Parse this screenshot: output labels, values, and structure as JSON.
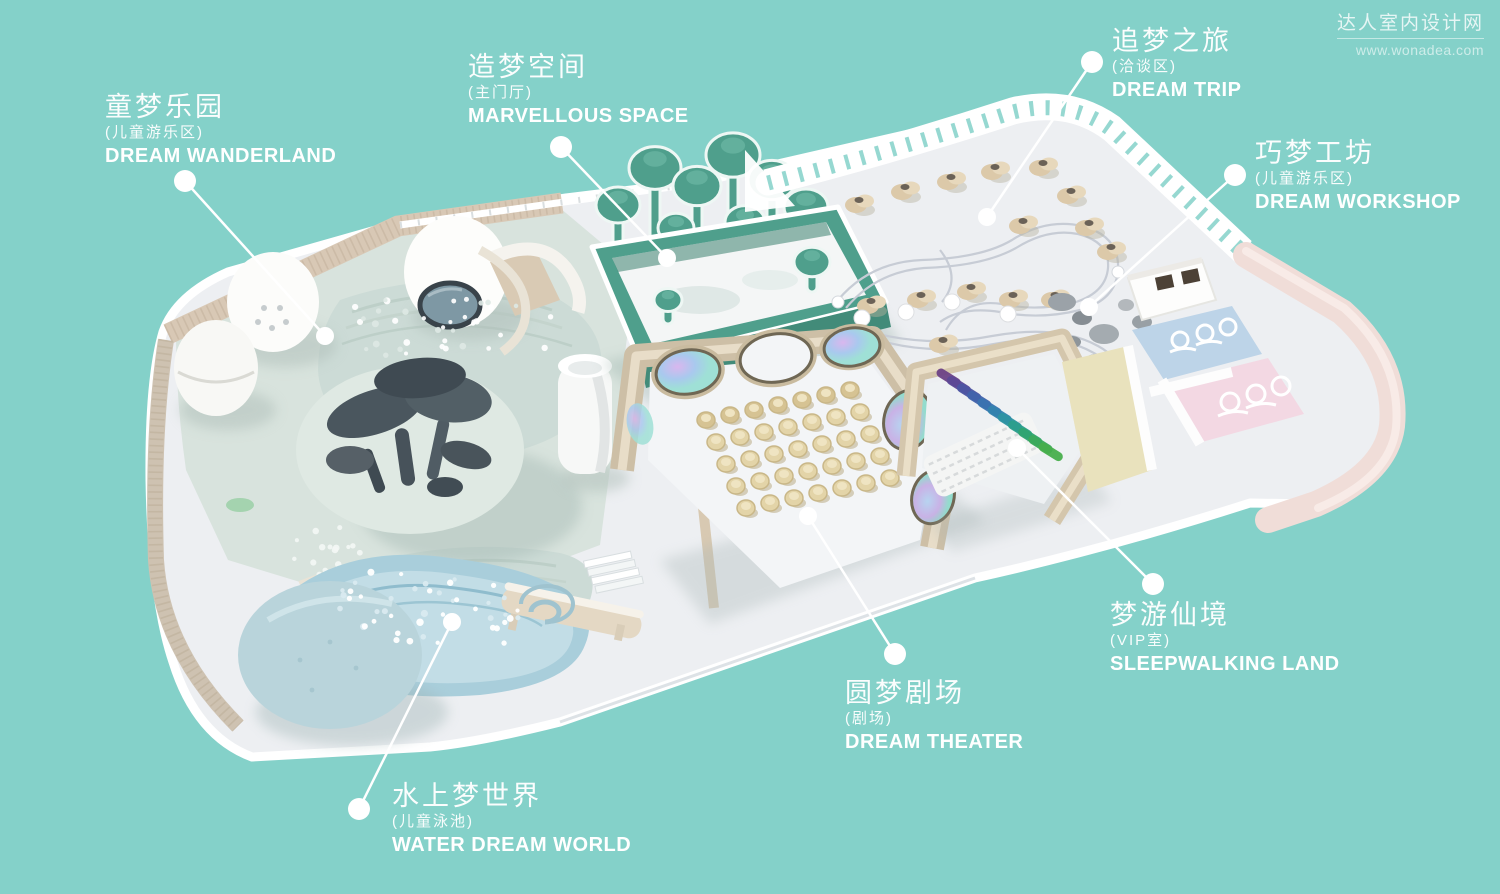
{
  "background_color": "#84d1c9",
  "watermark": {
    "site_name": "达人室内设计网",
    "site_url": "www.wonadea.com"
  },
  "labels": [
    {
      "id": "dream-wanderland",
      "zh": "童梦乐园",
      "zh_sub": "(儿童游乐区)",
      "en": "DREAM WANDERLAND"
    },
    {
      "id": "marvellous-space",
      "zh": "造梦空间",
      "zh_sub": "(主门厅)",
      "en": "MARVELLOUS SPACE"
    },
    {
      "id": "dream-trip",
      "zh": "追梦之旅",
      "zh_sub": "(洽谈区)",
      "en": "DREAM TRIP"
    },
    {
      "id": "dream-workshop",
      "zh": "巧梦工坊",
      "zh_sub": "(儿童游乐区)",
      "en": "DREAM WORKSHOP"
    },
    {
      "id": "sleepwalking-land",
      "zh": "梦游仙境",
      "zh_sub": "(VIP室)",
      "en": "SLEEPWALKING LAND"
    },
    {
      "id": "dream-theater",
      "zh": "圆梦剧场",
      "zh_sub": "(剧场)",
      "en": "DREAM THEATER"
    },
    {
      "id": "water-dream-world",
      "zh": "水上梦世界",
      "zh_sub": "(儿童泳池)",
      "en": "WATER DREAM WORLD"
    }
  ],
  "colors": {
    "background": "#84d1c9",
    "label_text": "#ffffff",
    "leader_line": "#ffffff",
    "floor_white": "#edeff2",
    "wanderland_floor": "#d8e3dd",
    "tree_sculpture": "#47525a",
    "entrance_green": "#4f9f8c",
    "theater_wall": "#cdbfa6",
    "theater_seat": "#e3d4a8",
    "pool_water": "#a9cedb",
    "workshop_pink": "#f3d8e3",
    "workshop_blue": "#bdd4e8",
    "outer_pink_wall": "#f0ddd8"
  }
}
